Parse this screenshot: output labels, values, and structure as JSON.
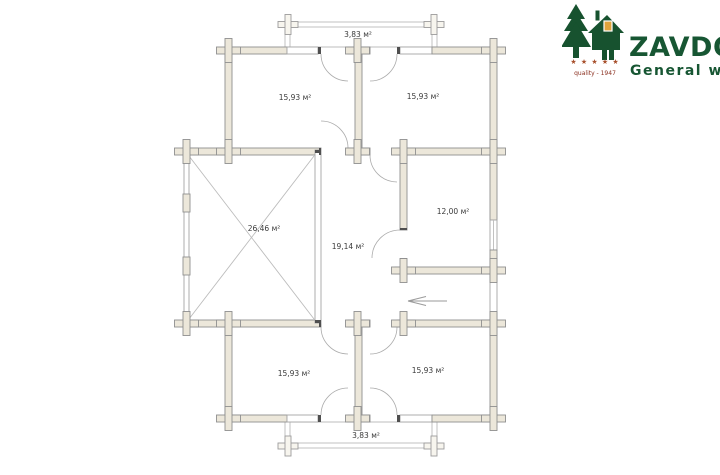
{
  "logo": {
    "brand": "ZAVDOZ",
    "tagline": "General wood",
    "quality_text": "quality - 1947",
    "stars": "★ ★ ★ ★ ★",
    "brand_color": "#175633",
    "star_color": "#a8502c"
  },
  "floorplan": {
    "rooms": [
      {
        "name": "porch-top",
        "label": "3,83 м²"
      },
      {
        "name": "bedroom-top-left",
        "label": "15,93 м²"
      },
      {
        "name": "bedroom-top-right",
        "label": "15,93 м²"
      },
      {
        "name": "terrace",
        "label": "26,46 м²"
      },
      {
        "name": "hall",
        "label": "19,14 м²"
      },
      {
        "name": "room-right",
        "label": "12,00 м²"
      },
      {
        "name": "bedroom-bottom-left",
        "label": "15,93 м²"
      },
      {
        "name": "bedroom-bottom-right",
        "label": "15,93 м²"
      },
      {
        "name": "porch-bottom",
        "label": "3,83 м²"
      }
    ],
    "colors": {
      "wall_fill": "#ece7da",
      "wall_line": "#8f8f8f",
      "thin_line": "#bcbcbc",
      "label_text": "#3a3a3a"
    }
  }
}
